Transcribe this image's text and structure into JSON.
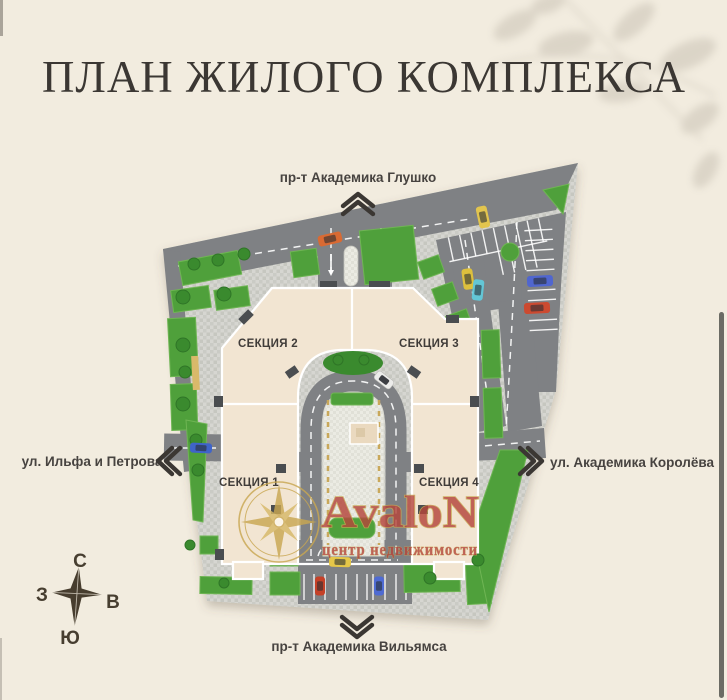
{
  "title": "ПЛАН ЖИЛОГО КОМПЛЕКСА",
  "streets": {
    "top": "пр-т Академика Глушко",
    "bottom": "пр-т Академика Вильямса",
    "left": "ул. Ильфа и Петрова",
    "right": "ул. Академика Королёва"
  },
  "sections": [
    {
      "label": "СЕКЦИЯ 1"
    },
    {
      "label": "СЕКЦИЯ 2"
    },
    {
      "label": "СЕКЦИЯ 3"
    },
    {
      "label": "СЕКЦИЯ 4"
    }
  ],
  "compass": {
    "north": "С",
    "south": "Ю",
    "west": "З",
    "east": "В"
  },
  "watermark": {
    "name": "AvaloN",
    "tagline": "центр недвижимости"
  },
  "icons": {
    "top_arrow": "double-chevron-up",
    "bottom_arrow": "double-chevron-down",
    "left_arrow": "double-chevron-left",
    "right_arrow": "double-chevron-right",
    "compass": "compass-rose",
    "logo": "compass-rose-logo"
  },
  "colors": {
    "background": "#f2ecdf",
    "road": "#7f8184",
    "cobble": "#d6d6d1",
    "green": "#4fa03b",
    "building": "#f2e5d2",
    "text_dark": "#3e3a36",
    "watermark_gold": "#c9a752",
    "watermark_red": "#b5463c"
  }
}
